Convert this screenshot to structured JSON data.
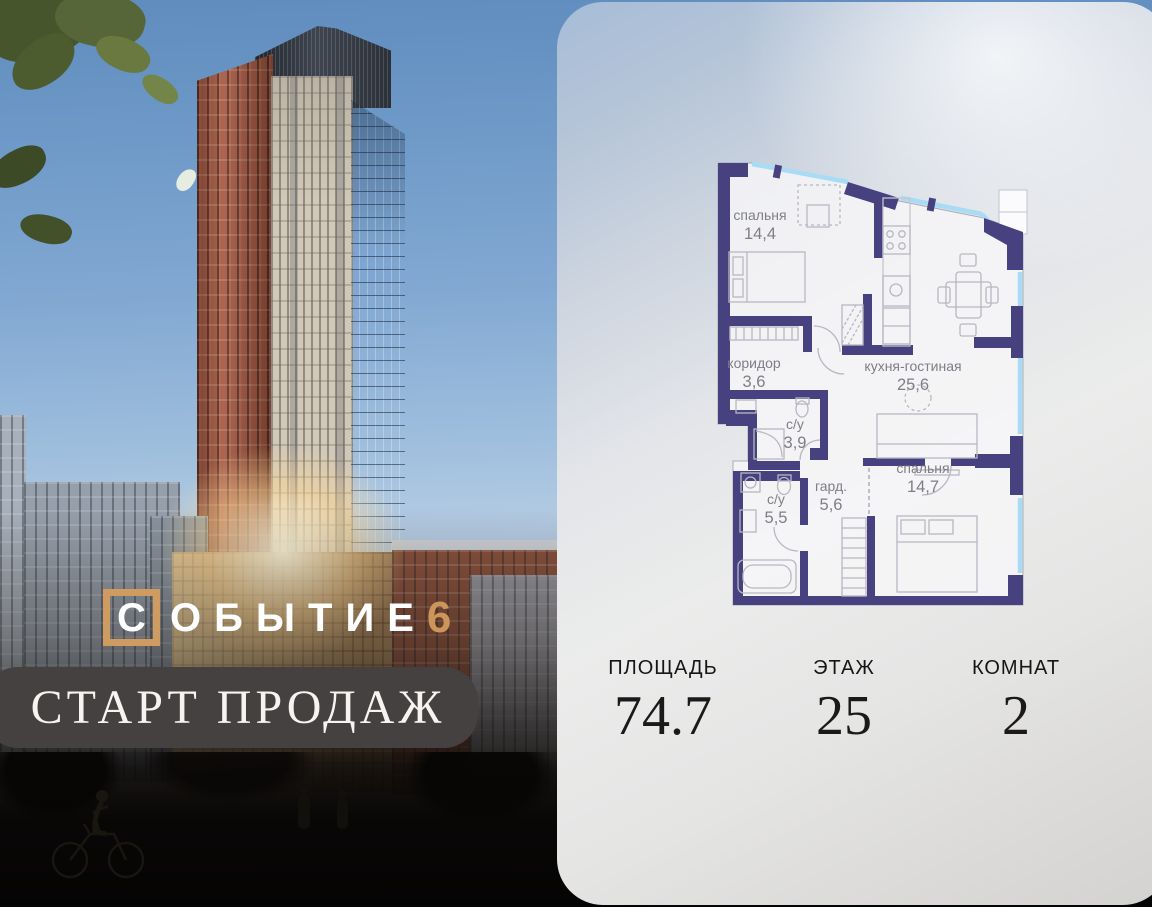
{
  "photo": {
    "logo": {
      "boxed_letter": "С",
      "word_rest": "ОБЫТИЕ",
      "number": "6"
    },
    "banner": {
      "text": "СТАРТ ПРОДАЖ"
    },
    "accent_color": "#d09b60"
  },
  "card": {
    "floor_plan": {
      "wall_color": "#484180",
      "window_color": "#a8dcf5",
      "rooms": [
        {
          "name": "спальня",
          "area": "14,4",
          "x": 70,
          "y": 72
        },
        {
          "name": "коридор",
          "area": "3,6",
          "x": 64,
          "y": 220
        },
        {
          "name": "кухня-гостиная",
          "area": "25,6",
          "x": 223,
          "y": 223
        },
        {
          "name": "с/у",
          "area": "3,9",
          "x": 105,
          "y": 281
        },
        {
          "name": "с/у",
          "area": "5,5",
          "x": 86,
          "y": 356
        },
        {
          "name": "гард.",
          "area": "5,6",
          "x": 141,
          "y": 343
        },
        {
          "name": "спальня",
          "area": "14,7",
          "x": 233,
          "y": 325
        }
      ]
    },
    "stats": [
      {
        "label": "ПЛОЩАДЬ",
        "value": "74.7"
      },
      {
        "label": "ЭТАЖ",
        "value": "25"
      },
      {
        "label": "КОМНАТ",
        "value": "2"
      }
    ]
  }
}
